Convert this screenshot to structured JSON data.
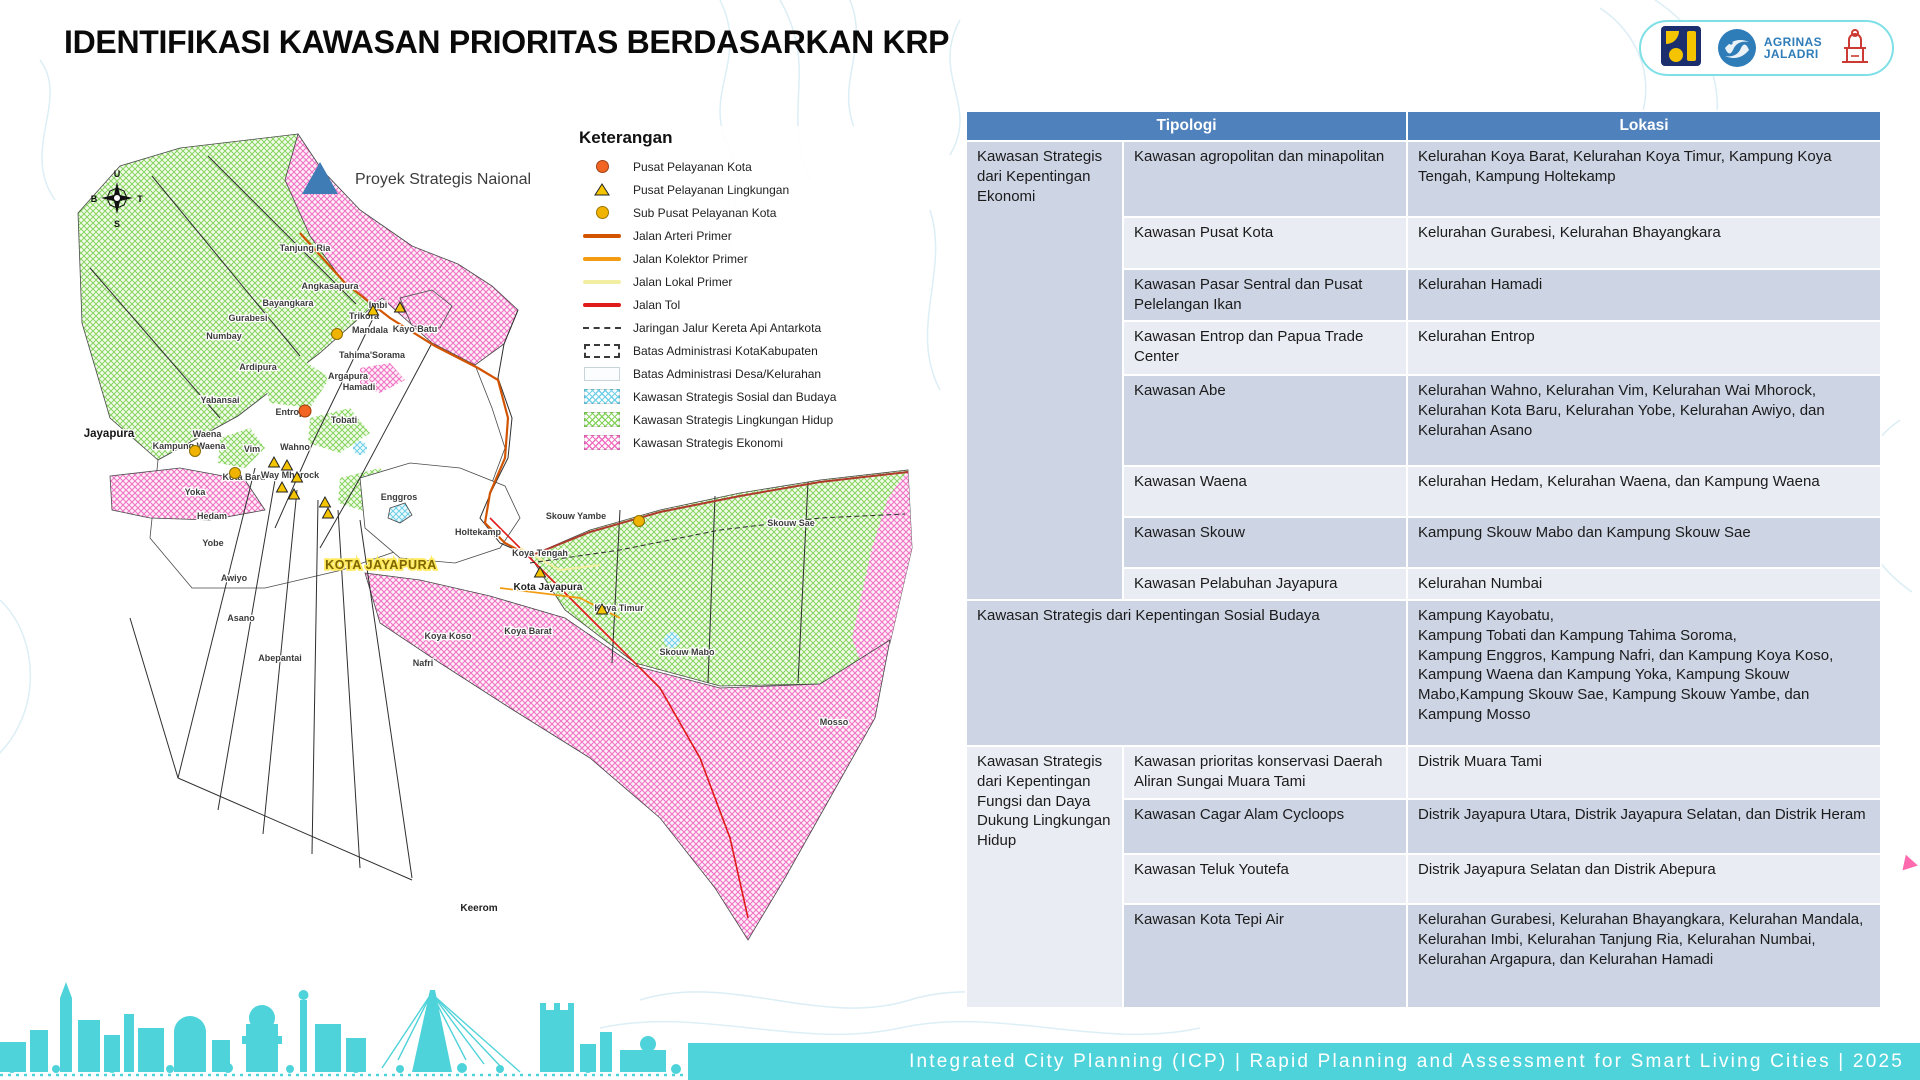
{
  "slide": {
    "title": "IDENTIFIKASI KAWASAN PRIORITAS BERDASARKAN KRP",
    "footer": "Integrated City Planning (ICP) | Rapid Planning and Assessment for Smart Living Cities | 2025"
  },
  "logos": {
    "agrinas_line1": "AGRINAS",
    "agrinas_line2": "JALADRI"
  },
  "colors": {
    "header_blue": "#4f81bd",
    "row_dark": "#cdd4e4",
    "row_light": "#e9ecf3",
    "teal_accent": "#4fd3da",
    "hatch_pink": "#f06ec0",
    "hatch_green": "#86d45e",
    "hatch_blue": "#6fd0e8",
    "psn_blue": "#3f7cb6"
  },
  "map": {
    "psn_label": "Proyek Strategis Naional",
    "compass": {
      "n": "U",
      "e": "T",
      "s": "S",
      "w": "B"
    },
    "legend": {
      "title": "Keterangan",
      "items": [
        {
          "type": "circle",
          "color": "#f26522",
          "label": "Pusat Pelayanan Kota"
        },
        {
          "type": "triangle",
          "color": "#f5c400",
          "label": "Pusat Pelayanan Lingkungan"
        },
        {
          "type": "circle",
          "color": "#f0b400",
          "label": "Sub Pusat Pelayanan Kota"
        },
        {
          "type": "line",
          "color": "#d35400",
          "label": "Jalan Arteri Primer"
        },
        {
          "type": "line",
          "color": "#f39c12",
          "label": "Jalan Kolektor Primer"
        },
        {
          "type": "line",
          "color": "#f3efa2",
          "label": "Jalan Lokal Primer"
        },
        {
          "type": "line",
          "color": "#e01b1b",
          "label": "Jalan Tol"
        },
        {
          "type": "dashline",
          "color": "#3a3a3a",
          "label": "Jaringan Jalur Kereta Api Antarkota"
        },
        {
          "type": "rect-dashed",
          "color": "#3a3a3a",
          "label": "Batas Administrasi KotaKabupaten"
        },
        {
          "type": "rect",
          "color": "#c9d4da",
          "label": "Batas Administrasi Desa/Kelurahan"
        },
        {
          "type": "hatch",
          "color": "#6fd0e8",
          "label": "Kawasan Strategis Sosial dan Budaya"
        },
        {
          "type": "hatch",
          "color": "#86d45e",
          "label": "Kawasan Strategis Lingkungan Hidup"
        },
        {
          "type": "hatch",
          "color": "#f06ec0",
          "label": "Kawasan Strategis Ekonomi"
        }
      ]
    },
    "labels": [
      {
        "t": "Jayapura",
        "x": 49,
        "y": 319,
        "cls": "region"
      },
      {
        "t": "KOTA JAYAPURA",
        "x": 321,
        "y": 451,
        "cls": "city"
      },
      {
        "t": "Tanjung Ria",
        "x": 245,
        "y": 133
      },
      {
        "t": "Angkasapura",
        "x": 270,
        "y": 171
      },
      {
        "t": "Bayangkara",
        "x": 228,
        "y": 188
      },
      {
        "t": "Gurabesi",
        "x": 188,
        "y": 203
      },
      {
        "t": "Numbay",
        "x": 164,
        "y": 221
      },
      {
        "t": "Imbi",
        "x": 318,
        "y": 190
      },
      {
        "t": "Trikora",
        "x": 304,
        "y": 201
      },
      {
        "t": "Mandala",
        "x": 310,
        "y": 215
      },
      {
        "t": "Kayo Batu",
        "x": 355,
        "y": 214
      },
      {
        "t": "Tahima'Sorama",
        "x": 312,
        "y": 240
      },
      {
        "t": "Ardipura",
        "x": 198,
        "y": 252
      },
      {
        "t": "Argapura",
        "x": 288,
        "y": 261
      },
      {
        "t": "Hamadi",
        "x": 299,
        "y": 272
      },
      {
        "t": "Yabansai",
        "x": 160,
        "y": 285
      },
      {
        "t": "Entrop",
        "x": 230,
        "y": 297
      },
      {
        "t": "Tobati",
        "x": 284,
        "y": 305
      },
      {
        "t": "Waena",
        "x": 147,
        "y": 319
      },
      {
        "t": "Kampung Waena",
        "x": 129,
        "y": 331
      },
      {
        "t": "Vim",
        "x": 192,
        "y": 334
      },
      {
        "t": "Wahno",
        "x": 235,
        "y": 332
      },
      {
        "t": "Kota Baru",
        "x": 184,
        "y": 362
      },
      {
        "t": "Way Mhorock",
        "x": 230,
        "y": 360
      },
      {
        "t": "Yoka",
        "x": 135,
        "y": 377
      },
      {
        "t": "Hedam",
        "x": 152,
        "y": 401
      },
      {
        "t": "Yobe",
        "x": 153,
        "y": 428
      },
      {
        "t": "Awiyo",
        "x": 174,
        "y": 463
      },
      {
        "t": "Asano",
        "x": 181,
        "y": 503
      },
      {
        "t": "Abepantai",
        "x": 220,
        "y": 543
      },
      {
        "t": "Nafri",
        "x": 363,
        "y": 548
      },
      {
        "t": "Enggros",
        "x": 339,
        "y": 382
      },
      {
        "t": "Holtekamp",
        "x": 418,
        "y": 417
      },
      {
        "t": "Skouw Yambe",
        "x": 516,
        "y": 401
      },
      {
        "t": "Skouw Sae",
        "x": 731,
        "y": 408
      },
      {
        "t": "Koya Tengah",
        "x": 480,
        "y": 438
      },
      {
        "t": "Kota Jayapura",
        "x": 488,
        "y": 472,
        "cls": "big"
      },
      {
        "t": "Koya Timur",
        "x": 559,
        "y": 493
      },
      {
        "t": "Koya Barat",
        "x": 468,
        "y": 516
      },
      {
        "t": "Koya Koso",
        "x": 388,
        "y": 521
      },
      {
        "t": "Skouw Mabo",
        "x": 627,
        "y": 537
      },
      {
        "t": "Mosso",
        "x": 774,
        "y": 607
      },
      {
        "t": "Keerom",
        "x": 419,
        "y": 793,
        "cls": "big"
      }
    ],
    "symbols": {
      "pusat_kota": [
        {
          "x": 245,
          "y": 293
        }
      ],
      "sub_pusat": [
        {
          "x": 277,
          "y": 216
        },
        {
          "x": 135,
          "y": 333
        },
        {
          "x": 175,
          "y": 355
        },
        {
          "x": 579,
          "y": 403
        }
      ],
      "pusat_lingkungan": [
        {
          "x": 313,
          "y": 193
        },
        {
          "x": 340,
          "y": 190
        },
        {
          "x": 214,
          "y": 345
        },
        {
          "x": 227,
          "y": 348
        },
        {
          "x": 237,
          "y": 360
        },
        {
          "x": 222,
          "y": 370
        },
        {
          "x": 234,
          "y": 377
        },
        {
          "x": 265,
          "y": 385
        },
        {
          "x": 268,
          "y": 396
        },
        {
          "x": 480,
          "y": 455
        },
        {
          "x": 542,
          "y": 492
        }
      ]
    }
  },
  "table": {
    "headers": [
      "Tipologi",
      "Lokasi"
    ],
    "sections": [
      {
        "tipologi": "Kawasan Strategis dari Kepentingan Ekonomi",
        "rows": [
          {
            "sub": "Kawasan agropolitan dan minapolitan",
            "lokasi": "Kelurahan Koya Barat, Kelurahan Koya Timur, Kampung Koya Tengah, Kampung Holtekamp"
          },
          {
            "sub": "Kawasan Pusat Kota",
            "lokasi": "Kelurahan Gurabesi, Kelurahan Bhayangkara"
          },
          {
            "sub": "Kawasan Pasar Sentral dan Pusat Pelelangan Ikan",
            "lokasi": "Kelurahan Hamadi"
          },
          {
            "sub": "Kawasan Entrop dan Papua Trade Center",
            "lokasi": "Kelurahan Entrop"
          },
          {
            "sub": "Kawasan Abe",
            "lokasi": "Kelurahan Wahno, Kelurahan Vim, Kelurahan Wai Mhorock, Kelurahan Kota Baru, Kelurahan Yobe, Kelurahan Awiyo, dan Kelurahan Asano"
          },
          {
            "sub": "Kawasan Waena",
            "lokasi": "Kelurahan Hedam, Kelurahan Waena, dan Kampung Waena"
          },
          {
            "sub": "Kawasan Skouw",
            "lokasi": "Kampung Skouw Mabo dan Kampung Skouw Sae"
          },
          {
            "sub": "Kawasan Pelabuhan Jayapura",
            "lokasi": "Kelurahan Numbai"
          }
        ]
      },
      {
        "tipologi": "Kawasan Strategis dari Kepentingan Sosial Budaya",
        "merged": true,
        "lokasi": "Kampung Kayobatu,\nKampung Tobati dan Kampung Tahima Soroma,\nKampung Enggros, Kampung Nafri, dan Kampung Koya Koso,\nKampung Waena dan Kampung Yoka, Kampung Skouw Mabo,Kampung Skouw Sae, Kampung Skouw Yambe, dan Kampung Mosso"
      },
      {
        "tipologi": "Kawasan Strategis dari Kepentingan Fungsi dan Daya Dukung Lingkungan Hidup",
        "rows": [
          {
            "sub": "Kawasan prioritas konservasi Daerah Aliran Sungai Muara Tami",
            "lokasi": "Distrik Muara Tami"
          },
          {
            "sub": "Kawasan Cagar Alam Cycloops",
            "lokasi": "Distrik Jayapura Utara, Distrik Jayapura Selatan, dan Distrik Heram"
          },
          {
            "sub": "Kawasan Teluk Youtefa",
            "lokasi": "Distrik Jayapura Selatan dan Distrik Abepura"
          },
          {
            "sub": "Kawasan Kota Tepi Air",
            "lokasi": "Kelurahan Gurabesi, Kelurahan Bhayangkara, Kelurahan Mandala, Kelurahan Imbi, Kelurahan Tanjung Ria, Kelurahan Numbai, Kelurahan Argapura, dan Kelurahan Hamadi"
          }
        ]
      }
    ]
  }
}
